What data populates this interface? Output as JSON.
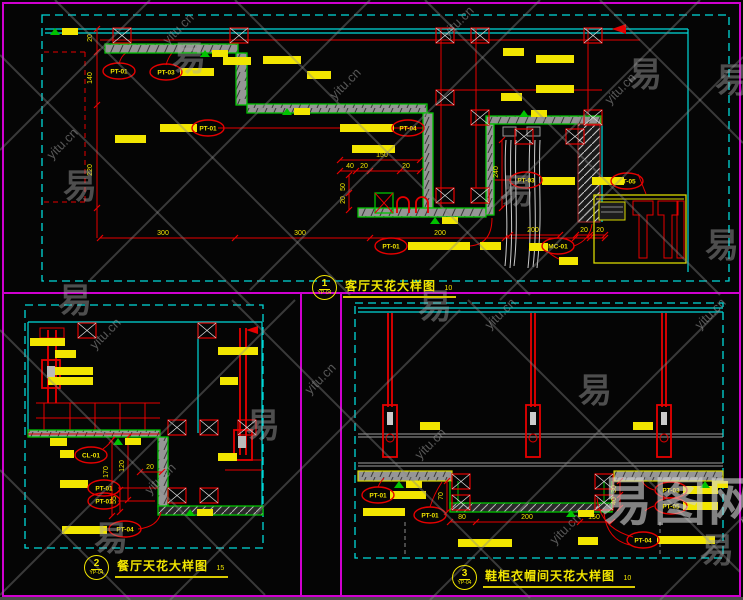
{
  "colors": {
    "magenta": "#d000d0",
    "cyan": "#00d9d9",
    "red": "#e60000",
    "green": "#00c300",
    "yellow": "#f2e600",
    "band_gray": "#969696"
  },
  "panels": [
    {
      "num": "1",
      "ref": "YP-04",
      "title": "客厅天花大样图",
      "scale": "10"
    },
    {
      "num": "2",
      "ref": "YP-04",
      "title": "餐厅天花大样图",
      "scale": "15"
    },
    {
      "num": "3",
      "ref": "YP-04",
      "title": "鞋柜衣帽间天花大样图",
      "scale": "10"
    }
  ],
  "material_tags": [
    {
      "label": "PT-01",
      "x": 119,
      "y": 71
    },
    {
      "label": "PT-03",
      "x": 166,
      "y": 72
    },
    {
      "label": "PT-01",
      "x": 208,
      "y": 128
    },
    {
      "label": "PT-04",
      "x": 408,
      "y": 128
    },
    {
      "label": "PT-03",
      "x": 526,
      "y": 180
    },
    {
      "label": "PT-05",
      "x": 627,
      "y": 181
    },
    {
      "label": "PT-01",
      "x": 391,
      "y": 246
    },
    {
      "label": "MC-01",
      "x": 558,
      "y": 246
    },
    {
      "label": "CL-01",
      "x": 91,
      "y": 455
    },
    {
      "label": "PT-01",
      "x": 104,
      "y": 488
    },
    {
      "label": "PT-01",
      "x": 104,
      "y": 501
    },
    {
      "label": "PT-04",
      "x": 125,
      "y": 529
    },
    {
      "label": "PT-01",
      "x": 378,
      "y": 495
    },
    {
      "label": "PT-01",
      "x": 430,
      "y": 515
    },
    {
      "label": "PT-03",
      "x": 671,
      "y": 490
    },
    {
      "label": "PT-05",
      "x": 671,
      "y": 506
    },
    {
      "label": "PT-04",
      "x": 643,
      "y": 540
    }
  ],
  "dimensions": [
    {
      "t": "300",
      "x": 163,
      "y": 235
    },
    {
      "t": "300",
      "x": 300,
      "y": 235
    },
    {
      "t": "200",
      "x": 440,
      "y": 235
    },
    {
      "t": "200",
      "x": 533,
      "y": 232
    },
    {
      "t": "20",
      "x": 584,
      "y": 232
    },
    {
      "t": "20",
      "x": 600,
      "y": 232
    },
    {
      "t": "20",
      "x": 92,
      "y": 38,
      "r": 1
    },
    {
      "t": "140",
      "x": 92,
      "y": 78,
      "r": 1
    },
    {
      "t": "220",
      "x": 92,
      "y": 170,
      "r": 1
    },
    {
      "t": "150",
      "x": 382,
      "y": 157
    },
    {
      "t": "40",
      "x": 350,
      "y": 168
    },
    {
      "t": "20",
      "x": 364,
      "y": 168
    },
    {
      "t": "20",
      "x": 406,
      "y": 168
    },
    {
      "t": "50",
      "x": 345,
      "y": 187,
      "r": 1
    },
    {
      "t": "20",
      "x": 345,
      "y": 200,
      "r": 1
    },
    {
      "t": "240",
      "x": 498,
      "y": 172,
      "r": 1
    },
    {
      "t": "170",
      "x": 108,
      "y": 472,
      "r": 1
    },
    {
      "t": "120",
      "x": 124,
      "y": 466,
      "r": 1
    },
    {
      "t": "20",
      "x": 150,
      "y": 469
    },
    {
      "t": "55",
      "x": 116,
      "y": 500,
      "r": 1
    },
    {
      "t": "70",
      "x": 443,
      "y": 496,
      "r": 1
    },
    {
      "t": "80",
      "x": 462,
      "y": 519
    },
    {
      "t": "200",
      "x": 527,
      "y": 519
    },
    {
      "t": "150",
      "x": 594,
      "y": 519
    },
    {
      "t": "30",
      "x": 616,
      "y": 489,
      "r": 1
    },
    {
      "t": "40",
      "x": 616,
      "y": 501,
      "r": 1
    }
  ],
  "annotation_bars": [
    [
      180,
      68,
      34
    ],
    [
      160,
      124,
      37
    ],
    [
      340,
      124,
      54
    ],
    [
      223,
      57,
      28
    ],
    [
      263,
      56,
      38
    ],
    [
      307,
      71,
      24
    ],
    [
      115,
      135,
      31
    ],
    [
      352,
      145,
      43
    ],
    [
      503,
      48,
      21
    ],
    [
      536,
      55,
      38
    ],
    [
      536,
      85,
      38
    ],
    [
      501,
      93,
      21
    ],
    [
      542,
      177,
      33
    ],
    [
      592,
      177,
      32
    ],
    [
      408,
      242,
      62
    ],
    [
      480,
      242,
      21
    ],
    [
      529,
      243,
      19
    ],
    [
      559,
      257,
      19
    ],
    [
      30,
      338,
      35
    ],
    [
      55,
      350,
      21
    ],
    [
      55,
      367,
      38
    ],
    [
      48,
      377,
      45
    ],
    [
      50,
      438,
      17
    ],
    [
      60,
      450,
      14
    ],
    [
      60,
      480,
      28
    ],
    [
      62,
      526,
      45
    ],
    [
      218,
      347,
      40
    ],
    [
      220,
      377,
      18
    ],
    [
      218,
      453,
      19
    ],
    [
      420,
      422,
      20
    ],
    [
      633,
      422,
      20
    ],
    [
      390,
      491,
      36
    ],
    [
      363,
      508,
      42
    ],
    [
      683,
      486,
      35
    ],
    [
      683,
      502,
      35
    ],
    [
      657,
      536,
      58
    ],
    [
      458,
      539,
      54
    ],
    [
      578,
      537,
      20
    ]
  ],
  "level_marks": [
    [
      50,
      28
    ],
    [
      200,
      50
    ],
    [
      282,
      108
    ],
    [
      430,
      217
    ],
    [
      519,
      110
    ],
    [
      113,
      438
    ],
    [
      185,
      509
    ],
    [
      394,
      481
    ],
    [
      566,
      510
    ],
    [
      700,
      481
    ]
  ],
  "xboxes": [
    [
      113,
      28
    ],
    [
      230,
      28
    ],
    [
      436,
      28
    ],
    [
      471,
      28
    ],
    [
      584,
      28
    ],
    [
      436,
      90
    ],
    [
      471,
      110
    ],
    [
      584,
      110
    ],
    [
      436,
      188
    ],
    [
      471,
      188
    ],
    [
      515,
      129
    ],
    [
      566,
      129
    ],
    [
      78,
      323
    ],
    [
      198,
      323
    ],
    [
      168,
      420
    ],
    [
      200,
      420
    ],
    [
      168,
      488
    ],
    [
      200,
      488
    ],
    [
      238,
      420
    ],
    [
      452,
      474
    ],
    [
      452,
      495
    ],
    [
      595,
      474
    ],
    [
      595,
      495
    ]
  ],
  "ticks": [
    [
      100,
      238
    ],
    [
      235,
      238
    ],
    [
      370,
      238
    ],
    [
      505,
      238
    ],
    [
      575,
      238
    ],
    [
      590,
      238
    ],
    [
      605,
      238
    ],
    [
      97,
      29
    ],
    [
      97,
      52
    ],
    [
      97,
      105
    ],
    [
      97,
      208
    ],
    [
      340,
      160
    ],
    [
      420,
      160
    ],
    [
      340,
      171
    ],
    [
      356,
      171
    ],
    [
      370,
      171
    ],
    [
      400,
      171
    ],
    [
      420,
      171
    ],
    [
      349,
      175
    ],
    [
      349,
      193
    ],
    [
      349,
      210
    ],
    [
      502,
      140
    ],
    [
      502,
      208
    ],
    [
      510,
      235
    ],
    [
      560,
      235
    ],
    [
      576,
      235
    ],
    [
      590,
      235
    ],
    [
      605,
      235
    ],
    [
      112,
      440
    ],
    [
      112,
      516
    ],
    [
      128,
      437
    ],
    [
      128,
      500
    ],
    [
      140,
      472
    ],
    [
      162,
      472
    ],
    [
      120,
      490
    ],
    [
      120,
      512
    ],
    [
      450,
      522
    ],
    [
      476,
      522
    ],
    [
      580,
      522
    ],
    [
      612,
      522
    ],
    [
      447,
      481
    ],
    [
      447,
      512
    ],
    [
      620,
      481
    ],
    [
      620,
      495
    ],
    [
      620,
      508
    ]
  ],
  "hangers_x": [
    390,
    533,
    664
  ],
  "watermarks": {
    "site": "yitu.cn",
    "logo_char": "易",
    "big_logo": "易图网",
    "big_logo_pos": [
      600,
      520
    ],
    "site_positions": [
      [
        52,
        160
      ],
      [
        168,
        45
      ],
      [
        335,
        100
      ],
      [
        448,
        38
      ],
      [
        610,
        105
      ],
      [
        95,
        350
      ],
      [
        310,
        395
      ],
      [
        490,
        330
      ],
      [
        700,
        330
      ],
      [
        150,
        495
      ],
      [
        420,
        460
      ],
      [
        555,
        545
      ]
    ],
    "logo_positions": [
      [
        63,
        198
      ],
      [
        172,
        70
      ],
      [
        500,
        203
      ],
      [
        628,
        86
      ],
      [
        715,
        92
      ],
      [
        705,
        257
      ],
      [
        58,
        312
      ],
      [
        418,
        318
      ],
      [
        246,
        437
      ],
      [
        94,
        550
      ],
      [
        578,
        402
      ],
      [
        700,
        562
      ]
    ],
    "line_segments": [
      [
        0,
        55,
        250,
        305
      ],
      [
        55,
        0,
        350,
        295
      ],
      [
        235,
        0,
        530,
        295
      ],
      [
        425,
        0,
        720,
        295
      ],
      [
        600,
        0,
        743,
        143
      ],
      [
        0,
        150,
        150,
        0
      ],
      [
        90,
        280,
        370,
        0
      ],
      [
        250,
        290,
        540,
        0
      ],
      [
        430,
        270,
        700,
        0
      ],
      [
        500,
        300,
        743,
        57
      ],
      [
        0,
        330,
        265,
        595
      ],
      [
        232,
        300,
        530,
        598
      ],
      [
        468,
        300,
        740,
        572
      ],
      [
        0,
        470,
        130,
        600
      ],
      [
        0,
        595,
        295,
        300
      ],
      [
        170,
        600,
        460,
        310
      ],
      [
        430,
        600,
        720,
        310
      ],
      [
        660,
        600,
        743,
        517
      ]
    ]
  }
}
